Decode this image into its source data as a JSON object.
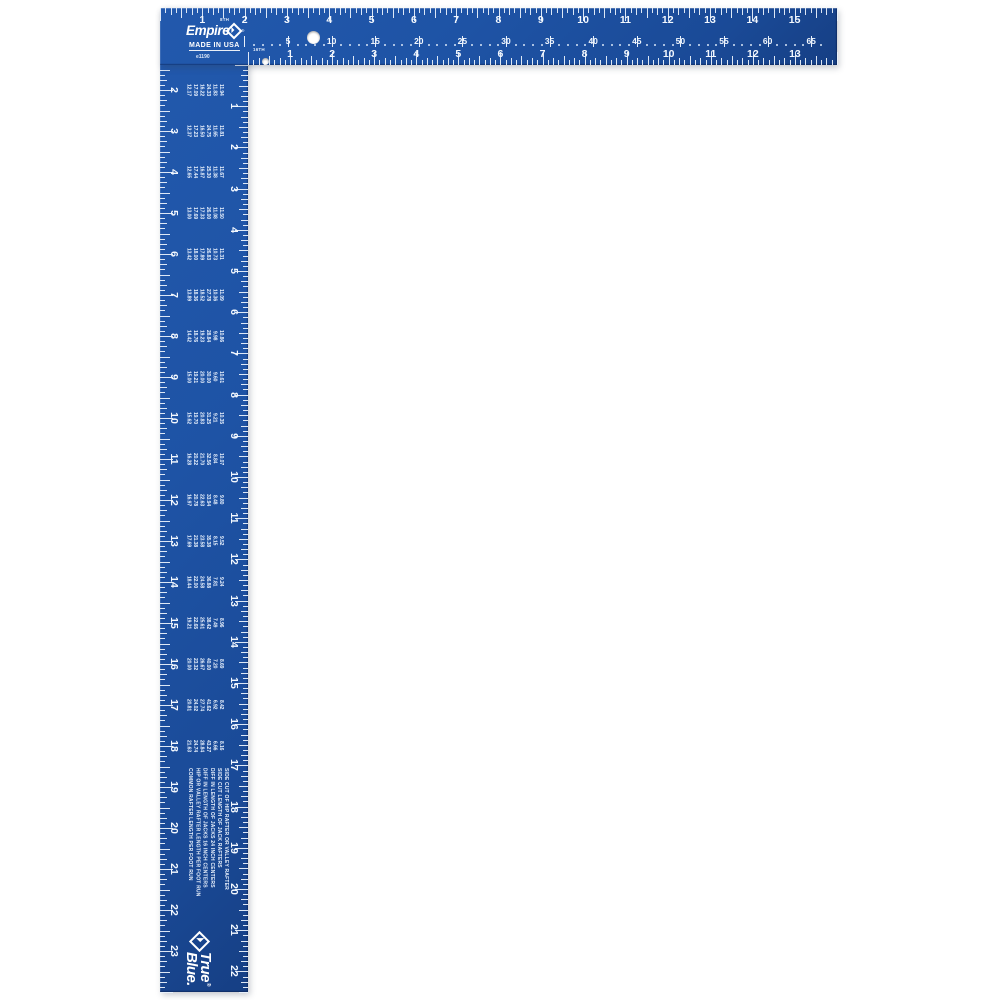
{
  "brand": {
    "name": "Empire",
    "registered": "®",
    "made_in": "MADE IN USA",
    "model": "e1190"
  },
  "tongue": {
    "outer_scale": {
      "numbers": [
        1,
        2,
        3,
        4,
        5,
        6,
        7,
        8,
        9,
        10,
        11,
        12,
        13,
        14,
        15
      ],
      "note": "8TH"
    },
    "octagon_scale": {
      "numbers": [
        5,
        10,
        15,
        20,
        25,
        30,
        35,
        40,
        45,
        50,
        55,
        60,
        65
      ]
    },
    "inner_scale": {
      "numbers": [
        1,
        2,
        3,
        4,
        5,
        6,
        7,
        8,
        9,
        10,
        11,
        12,
        13
      ],
      "note": "16TH"
    }
  },
  "blade": {
    "outer_scale": {
      "numbers": [
        1,
        2,
        3,
        4,
        5,
        6,
        7,
        8,
        9,
        10,
        11,
        12,
        13,
        14,
        15,
        16,
        17,
        18,
        19,
        20,
        21,
        22,
        23
      ]
    },
    "inner_scale": {
      "numbers": [
        1,
        2,
        3,
        4,
        5,
        6,
        7,
        8,
        9,
        10,
        11,
        12,
        13,
        14,
        15,
        16,
        17,
        18,
        19,
        20,
        21,
        22
      ]
    },
    "rafter_table": {
      "row_labels": [
        "COMMON RAFTER LENGTH PER FOOT RUN",
        "HIP OR VALLEY RAFTER LENGTH PER FOOT RUN",
        "DIFF IN LENGTH OF JACKS 16 INCH CENTERS",
        "DIFF IN LENGTH OF JACKS 24 INCH CENTERS",
        "SIDE CUT LENGTH OF JACK RAFTERS",
        "SIDE CUT OF HIP RAFTER OR VALLEY RAFTER"
      ],
      "rises": [
        2,
        3,
        4,
        5,
        6,
        7,
        8,
        9,
        10,
        11,
        12,
        13,
        14,
        15,
        16,
        17,
        18
      ],
      "rows": {
        "common": [
          "12.17",
          "12.37",
          "12.65",
          "13.00",
          "13.42",
          "13.89",
          "14.42",
          "15.00",
          "15.62",
          "16.28",
          "16.97",
          "17.69",
          "18.44",
          "19.21",
          "20.00",
          "20.81",
          "21.63"
        ],
        "hip_valley": [
          "17.09",
          "17.23",
          "17.44",
          "17.69",
          "18.00",
          "18.36",
          "18.76",
          "19.21",
          "19.70",
          "20.22",
          "20.78",
          "21.38",
          "22.00",
          "22.65",
          "23.32",
          "24.02",
          "24.74"
        ],
        "jacks_16": [
          "16.22",
          "16.50",
          "16.87",
          "17.33",
          "17.89",
          "18.52",
          "19.23",
          "20.00",
          "20.83",
          "21.70",
          "22.63",
          "23.58",
          "24.58",
          "25.61",
          "26.67",
          "27.74",
          "28.84"
        ],
        "jacks_24": [
          "24.33",
          "24.75",
          "25.30",
          "26.00",
          "26.83",
          "27.78",
          "28.84",
          "30.00",
          "31.25",
          "32.56",
          "33.94",
          "35.38",
          "36.88",
          "38.42",
          "40.00",
          "41.62",
          "43.27"
        ],
        "side_cut_jacks": [
          "11.83",
          "11.65",
          "11.38",
          "11.08",
          "10.73",
          "10.36",
          "9.98",
          "9.60",
          "9.21",
          "8.84",
          "8.48",
          "8.15",
          "7.81",
          "7.49",
          "7.20",
          "6.92",
          "6.66"
        ],
        "side_cut_hip_valley": [
          "11.94",
          "11.81",
          "11.67",
          "11.50",
          "11.31",
          "11.09",
          "10.86",
          "10.61",
          "10.35",
          "10.07",
          "9.80",
          "9.52",
          "9.24",
          "8.96",
          "8.69",
          "8.42",
          "8.16"
        ]
      }
    },
    "true_blue": {
      "word1": "True",
      "word2": "Blue",
      "registered": "®",
      "period": "."
    }
  },
  "colors": {
    "square_blue": "#1e53a5",
    "square_blue_dark": "#163f84",
    "markings_white": "#f3f8fe",
    "background": "#ffffff"
  }
}
